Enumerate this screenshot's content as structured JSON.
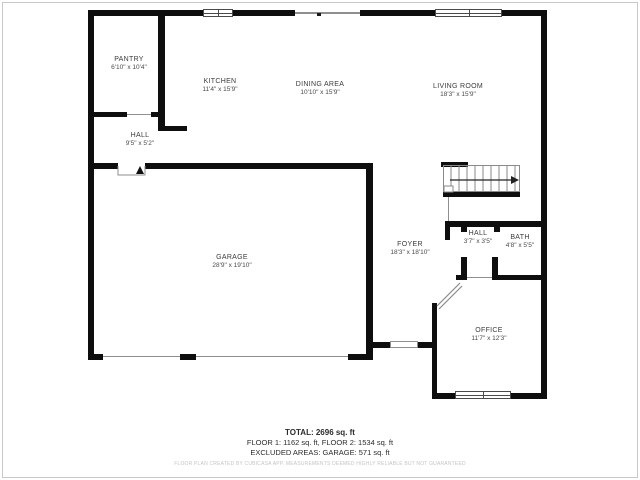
{
  "floorplan": {
    "rooms": {
      "pantry": {
        "name": "PANTRY",
        "dims": "6'10\" x 10'4\""
      },
      "kitchen": {
        "name": "KITCHEN",
        "dims": "11'4\" x 15'9\""
      },
      "dining": {
        "name": "DINING AREA",
        "dims": "10'10\" x 15'9\""
      },
      "living": {
        "name": "LIVING ROOM",
        "dims": "18'3\" x 15'9\""
      },
      "hallUpper": {
        "name": "HALL",
        "dims": "9'5\" x 5'2\""
      },
      "garage": {
        "name": "GARAGE",
        "dims": "28'9\" x 19'10\""
      },
      "foyer": {
        "name": "FOYER",
        "dims": "18'3\" x 18'10\""
      },
      "hallLower": {
        "name": "HALL",
        "dims": "3'7\" x 3'5\""
      },
      "bath": {
        "name": "BATH",
        "dims": "4'8\" x 5'5\""
      },
      "office": {
        "name": "OFFICE",
        "dims": "11'7\" x 12'3\""
      }
    },
    "summary": {
      "total": "TOTAL: 2696 sq. ft",
      "floors": "FLOOR 1: 1162 sq. ft, FLOOR 2: 1534 sq. ft",
      "excluded": "EXCLUDED AREAS: GARAGE: 571 sq. ft",
      "disclaimer": "FLOOR PLAN CREATED BY CUBICASA APP. MEASUREMENTS DEEMED HIGHLY RELIABLE BUT NOT GUARANTEED"
    },
    "colors": {
      "wall": "#0e0e0e",
      "background": "#ffffff",
      "frame": "#c9c9c9"
    }
  }
}
